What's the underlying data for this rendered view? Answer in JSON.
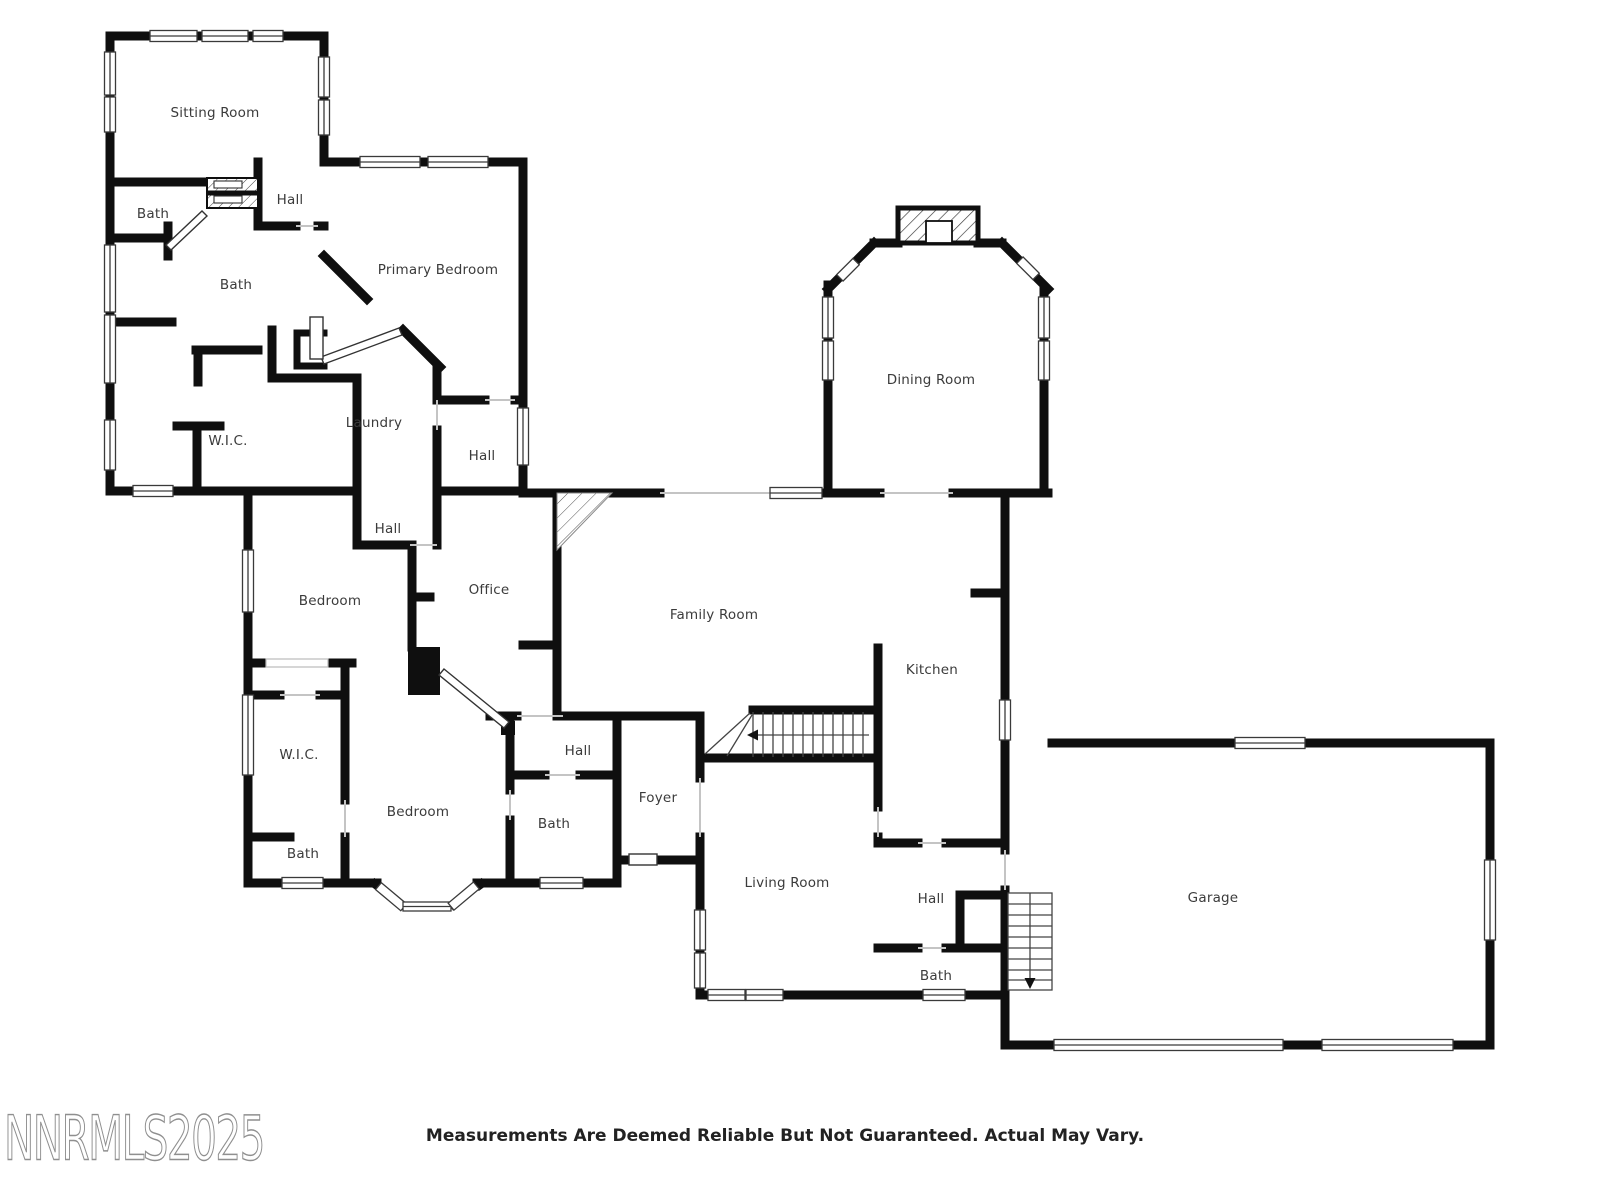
{
  "page": {
    "background": "#ffffff"
  },
  "watermark": {
    "text": "NNRMLS2025",
    "color": "#8f8f8f"
  },
  "disclaimer": {
    "text": "Measurements Are Deemed Reliable But Not Guaranteed. Actual May Vary.",
    "color": "#222222"
  },
  "plan": {
    "wall_color": "#0f0f0f",
    "label_color": "#3b3b3b",
    "open_line_color": "#c4c4c4",
    "window_frame_color": "#3a3a3a",
    "rooms": [
      {
        "id": "sitting-room",
        "label": "Sitting Room"
      },
      {
        "id": "bath-upper",
        "label": "Bath"
      },
      {
        "id": "hall-upper",
        "label": "Hall"
      },
      {
        "id": "bath-main",
        "label": "Bath"
      },
      {
        "id": "primary-bedroom",
        "label": "Primary Bedroom"
      },
      {
        "id": "wic-upper",
        "label": "W.I.C."
      },
      {
        "id": "laundry",
        "label": "Laundry"
      },
      {
        "id": "hall-east",
        "label": "Hall"
      },
      {
        "id": "hall-mid",
        "label": "Hall"
      },
      {
        "id": "bedroom-mid",
        "label": "Bedroom"
      },
      {
        "id": "office",
        "label": "Office"
      },
      {
        "id": "family-room",
        "label": "Family Room"
      },
      {
        "id": "dining-room",
        "label": "Dining Room"
      },
      {
        "id": "kitchen",
        "label": "Kitchen"
      },
      {
        "id": "wic-lower",
        "label": "W.I.C."
      },
      {
        "id": "hall-lower",
        "label": "Hall"
      },
      {
        "id": "bath-lower-mid",
        "label": "Bath"
      },
      {
        "id": "foyer",
        "label": "Foyer"
      },
      {
        "id": "bedroom-lower",
        "label": "Bedroom"
      },
      {
        "id": "bath-lower-left",
        "label": "Bath"
      },
      {
        "id": "living-room",
        "label": "Living Room"
      },
      {
        "id": "hall-garage",
        "label": "Hall"
      },
      {
        "id": "bath-garage",
        "label": "Bath"
      },
      {
        "id": "garage",
        "label": "Garage"
      }
    ],
    "icons": {
      "stairs_main_arrow": "arrow-left",
      "stairs_garage_arrow": "arrow-down"
    }
  }
}
